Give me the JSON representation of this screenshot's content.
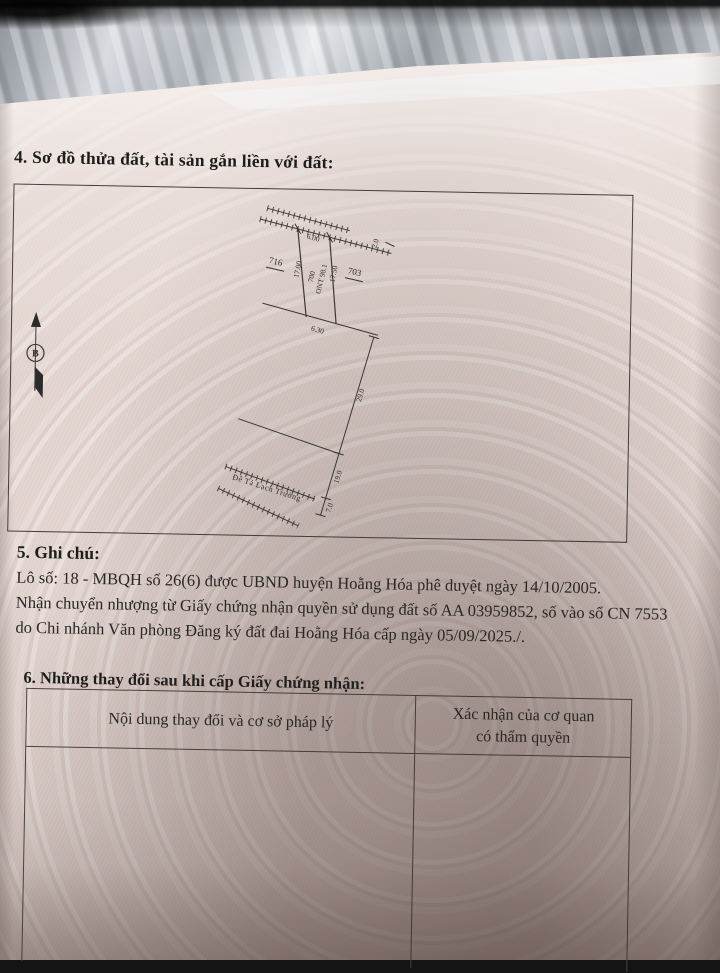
{
  "colors": {
    "paper": "#e2d4cf",
    "ink": "#1f1f1f",
    "line": "#433f3c"
  },
  "section4": {
    "heading": "4. Sơ đồ thửa đất, tài sản gắn liền với đất:",
    "diagram": {
      "north_marker": "B",
      "parcel": {
        "number": "700",
        "land_use_area": "ONT 98.1"
      },
      "adjacent_parcels": {
        "left": "716",
        "right": "703"
      },
      "dimensions": {
        "top": "6.00",
        "left": "17.00",
        "right": "17.50",
        "bottom": "6.30",
        "road_width": "2.0",
        "offset_1": "29.0",
        "offset_2": "19.0",
        "offset_3": "7.0"
      },
      "road_label": "Đê Tả Lạch Trường"
    }
  },
  "section5": {
    "heading": "5. Ghi chú:",
    "lines": [
      "Lô số: 18 - MBQH số 26(6) được UBND huyện Hoằng Hóa phê duyệt ngày 14/10/2005.",
      "Nhận chuyển nhượng từ Giấy chứng nhận quyền sử dụng đất số AA 03959852, số vào sổ CN 7553",
      "do Chi nhánh Văn phòng Đăng ký đất đai Hoằng Hóa cấp ngày 05/09/2025./."
    ]
  },
  "section6": {
    "heading": "6. Những thay đổi sau khi cấp Giấy chứng nhận:",
    "table": {
      "col1_header": "Nội dung thay đổi và cơ sở pháp lý",
      "col2_lines": [
        "Xác nhận của cơ quan",
        "có thẩm quyền"
      ]
    }
  }
}
